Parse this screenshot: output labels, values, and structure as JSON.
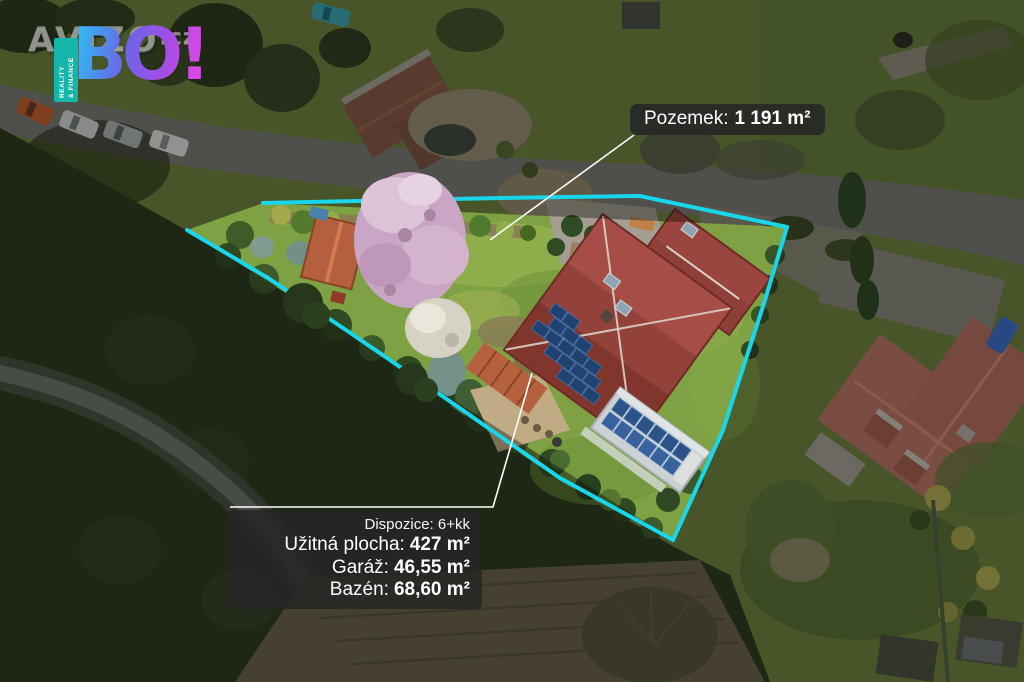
{
  "brand": {
    "watermark_main": "AVIZO",
    "watermark_tld": ".cz",
    "logo_text": "BO!",
    "tagline_line1": "REALITY",
    "tagline_line2": "& FINANCE"
  },
  "overlays": {
    "land": {
      "label": "Pozemek:",
      "value": "1 191 m²"
    },
    "info": {
      "disposition": {
        "label": "Dispozice:",
        "value": "6+kk"
      },
      "rows": [
        {
          "label": "Užitná plocha:",
          "value": "427 m²"
        },
        {
          "label": "Garáž:",
          "value": "46,55 m²"
        },
        {
          "label": "Bazén:",
          "value": "68,60 m²"
        }
      ]
    }
  },
  "colors": {
    "boundary_line": "#18d6ec",
    "leader_line": "#ffffff",
    "label_background": "#262626",
    "label_text": "#ffffff",
    "brand_teal": "#14b5aa",
    "brand_gradient_start": "#35b4f2",
    "brand_gradient_end": "#d848e8"
  }
}
